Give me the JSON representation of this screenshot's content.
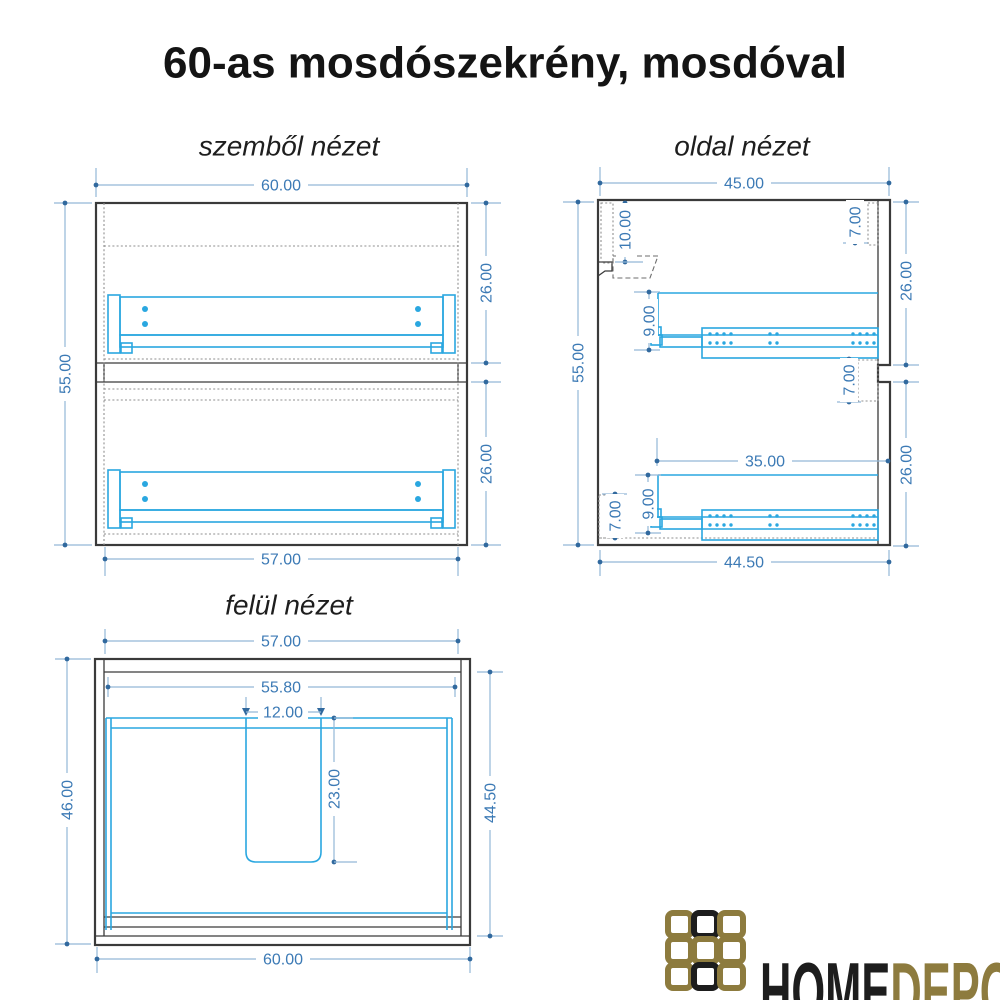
{
  "title": "60-as mosdószekrény, mosdóval",
  "colors": {
    "line-dark": "#3a3a3a",
    "line-dotted": "#8f8f8f",
    "drawer-cyan": "#2aa7e0",
    "dim-line": "#93b7d7",
    "dim-dot": "#31699e",
    "dim-text": "#3c7ab5",
    "logo-gold": "#8d7b3e",
    "logo-black": "#1d1d1d"
  },
  "views": {
    "front": {
      "label": "szemből nézet",
      "dims": {
        "outer_width": "60.00",
        "outer_height": "55.00",
        "upper_drawer_front": "26.00",
        "lower_drawer_front": "26.00",
        "inner_width": "57.00"
      }
    },
    "side": {
      "label": "oldal nézet",
      "dims": {
        "outer_depth": "45.00",
        "outer_height": "55.00",
        "back_rail": "10.00",
        "top_inset": "7.00",
        "upper_front_height": "26.00",
        "upper_rail": "9.00",
        "mid_inset": "7.00",
        "slide_length": "35.00",
        "lower_front_height": "26.00",
        "lower_rail": "9.00",
        "bottom_inset": "7.00",
        "inner_depth": "44.50"
      }
    },
    "top": {
      "label": "felül nézet",
      "dims": {
        "inner_width": "57.00",
        "clear_width": "55.80",
        "sink_width": "12.00",
        "outer_depth": "46.00",
        "sink_depth": "23.00",
        "inner_depth": "44.50",
        "outer_width": "60.00"
      }
    }
  },
  "logo": {
    "home": "HOME",
    "depo": "DEPO"
  }
}
